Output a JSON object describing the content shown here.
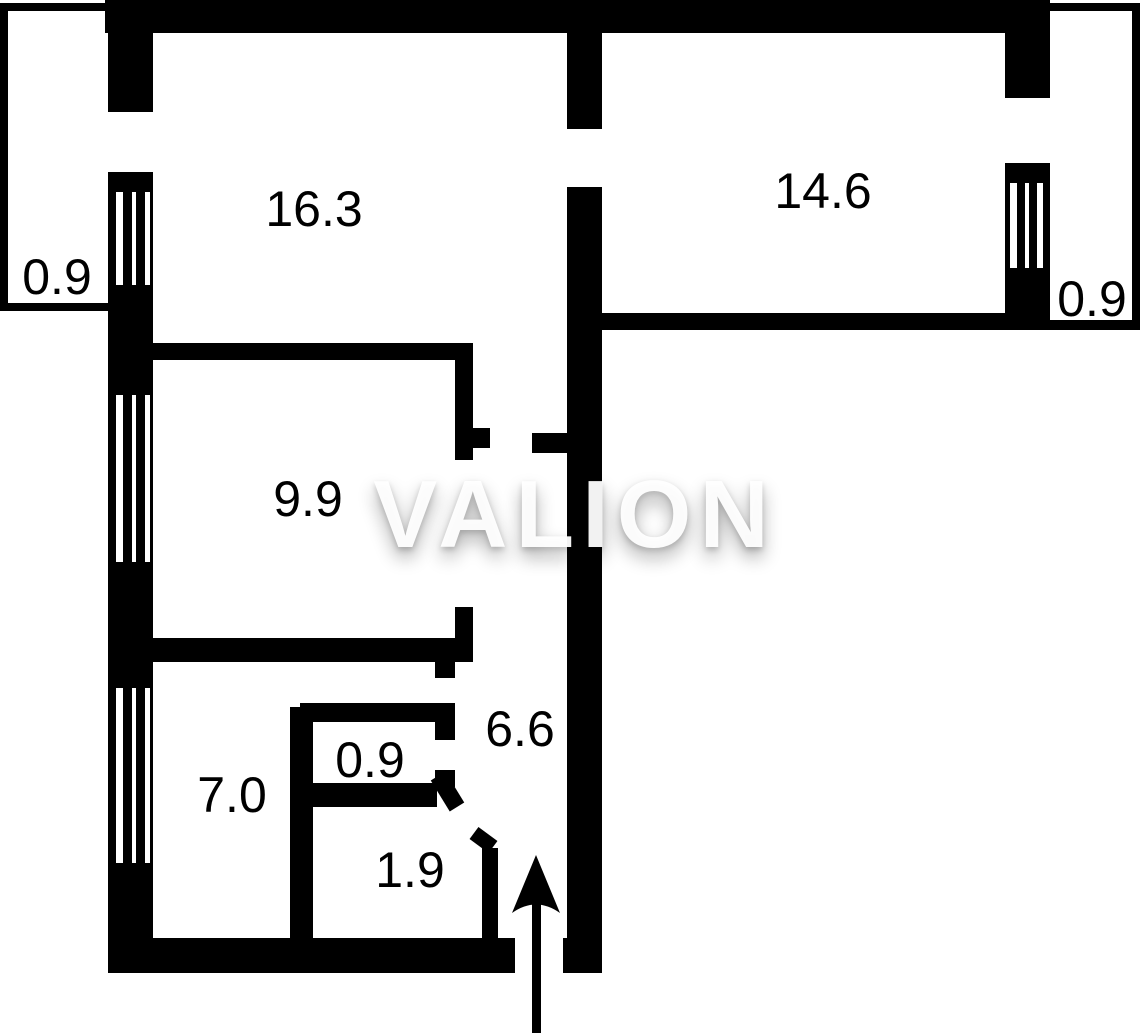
{
  "plan": {
    "watermark": "VALION",
    "labels": {
      "living_room": "16.3",
      "bedroom_right": "14.6",
      "balcony_left": "0.9",
      "balcony_right": "0.9",
      "bedroom_small": "9.9",
      "hallway": "6.6",
      "kitchen": "7.0",
      "wc": "0.9",
      "bathroom": "1.9"
    },
    "colors": {
      "wall": "#000000",
      "background": "#ffffff",
      "label_text": "#000000",
      "watermark_text": "#ffffff"
    }
  }
}
